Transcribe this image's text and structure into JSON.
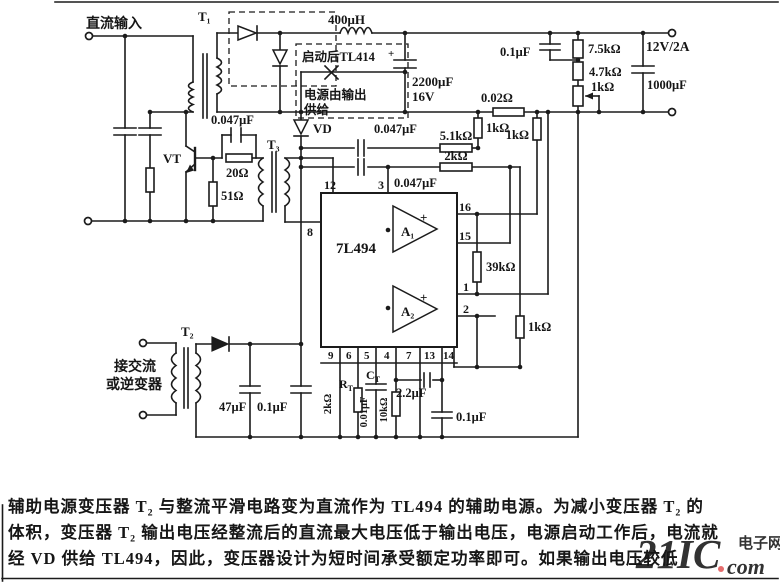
{
  "schematic": {
    "terminals": {
      "dc_input": "直流输入",
      "output_rating": "12V/2A",
      "ac_line1": "接交流",
      "ac_line2": "或逆变器"
    },
    "transformers": {
      "t1": "T₁",
      "t2": "T₂",
      "t3": "T₃"
    },
    "semis": {
      "vt": "VT",
      "vd": "VD"
    },
    "annotation": {
      "line1": "启动后TL414",
      "line2": "电源由输出",
      "line3": "供给"
    },
    "components": {
      "l1": "400μH",
      "c2200": "2200μF",
      "c2200_v": "16V",
      "plus": "+",
      "c01_top": "0.1μF",
      "r75": "7.5kΩ",
      "r47": "4.7kΩ",
      "r1_pot": "1kΩ",
      "c1000": "1000μF",
      "r002": "0.02Ω",
      "r1_a": "1kΩ",
      "r1_b": "1kΩ",
      "r1_c": "1kΩ",
      "c047_a": "0.047μF",
      "c047_b": "0.047μF",
      "c047_c": "0.047μF",
      "r51k": "5.1kΩ",
      "r2k": "2kΩ",
      "r39k": "39kΩ",
      "r20": "20Ω",
      "r51": "51Ω",
      "rt_main": "R",
      "rt_sub": "T",
      "rt_val": "2kΩ",
      "ct_main": "C",
      "ct_sub": "T",
      "ct_val": "0.01μF",
      "r10k": "10kΩ",
      "c22": "2.2μF",
      "c01_bot": "0.1μF",
      "c47": "47μF",
      "c01_t2": "0.1μF"
    },
    "chip": {
      "name": "7L494",
      "amp1": "A₁",
      "amp2": "A₂",
      "plus": "+",
      "pin12": "12",
      "pin3": "3",
      "pin8": "8",
      "pin16": "16",
      "pin15": "15",
      "pin1": "1",
      "pin2": "2",
      "pins_bottom": [
        "9",
        "6",
        "5",
        "4",
        "7",
        "13",
        "14"
      ]
    }
  },
  "description": {
    "line1": "辅助电源变压器 T₂ 与整流平滑电路变为直流作为 TL494 的辅助电源。为减小变压器 T₂ 的",
    "line2": "体积，变压器 T₂ 输出电压经整流后的直流最大电压低于输出电压，电源启动工作后，电流就",
    "line3": "经 VD 供给 TL494，因此，变压器设计为短时间承受额定功率即可。如果输出电压较低"
  },
  "watermark": {
    "brand": "21IC",
    "cn": "电子网",
    "suffix": "com"
  }
}
